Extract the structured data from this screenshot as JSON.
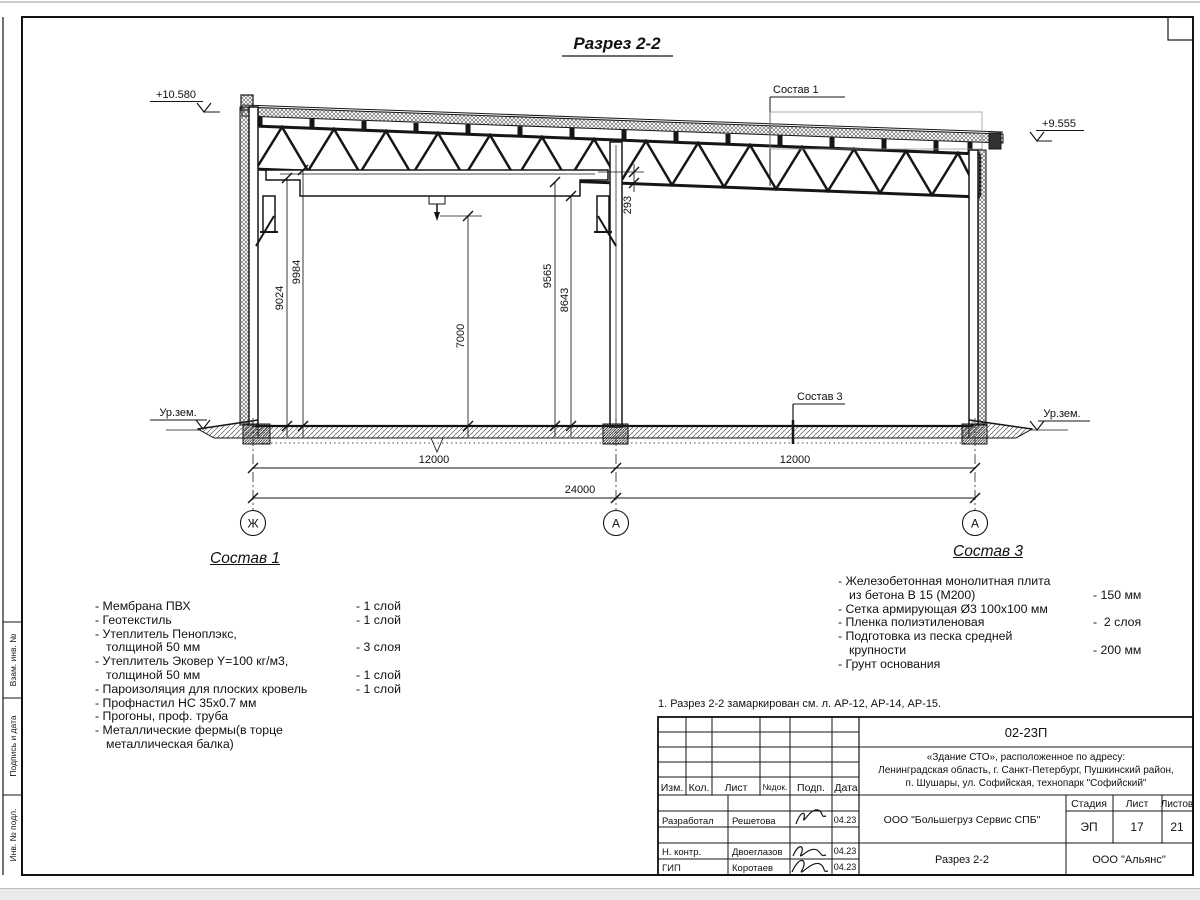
{
  "title": "Разрез 2-2",
  "note": "1. Разрез 2-2 замаркирован см. л. АР-12, АР-14, АР-15.",
  "drawing": {
    "elevations": {
      "left": "+10.580",
      "right": "+9.555"
    },
    "ground_labels": {
      "left": "Ур.зем.",
      "right": "Ур.зем."
    },
    "leaders": {
      "top": "Состав 1",
      "bottom": "Состав 3"
    },
    "dims": {
      "v1": "9024",
      "v2": "9984",
      "v3": "7000",
      "v4": "9565",
      "v5": "8643",
      "v6": "293",
      "bay1": "12000",
      "bay2": "12000",
      "total": "24000"
    },
    "axes": [
      "Ж",
      "А",
      "А"
    ]
  },
  "composition1": {
    "title": "Состав 1",
    "items": [
      {
        "text": "- Мембрана ПВХ",
        "qty": "- 1 слой"
      },
      {
        "text": "- Геотекстиль",
        "qty": "- 1 слой"
      },
      {
        "text": "- Утеплитель Пеноплэкс,\nтолщиной 50 мм",
        "qty": "- 3 слоя"
      },
      {
        "text": "- Утеплитель Эковер Y=100 кг/м3,\nтолщиной 50 мм",
        "qty": "- 1 слой"
      },
      {
        "text": "- Пароизоляция для плоских кровель",
        "qty": "- 1 слой"
      },
      {
        "text": "- Профнастил НС 35х0.7 мм",
        "qty": ""
      },
      {
        "text": "- Прогоны, проф. труба",
        "qty": ""
      },
      {
        "text": "- Металлические фермы(в торце металлическая балка)",
        "qty": ""
      }
    ]
  },
  "composition3": {
    "title": "Состав 3",
    "items": [
      {
        "text": "- Железобетонная  монолитная плита\nиз бетона В 15 (М200)",
        "qty": "- 150 мм"
      },
      {
        "text": "- Сетка армирующая Ø3 100х100 мм",
        "qty": ""
      },
      {
        "text": "- Пленка полиэтиленовая",
        "qty": "-  2 слоя"
      },
      {
        "text": "- Подготовка из песка средней\nкрупности",
        "qty": "- 200 мм"
      },
      {
        "text": "- Грунт основания",
        "qty": ""
      }
    ]
  },
  "titleblock": {
    "doc_number": "02-23П",
    "project_lines": [
      "«Здание СТО», расположенное по адресу:",
      "Ленинградская область, г. Санкт-Петербург, Пушкинский район,",
      "п. Шушары, ул. Софийская, технопарк \"Софийский\""
    ],
    "columns": [
      "Изм.",
      "Кол.",
      "Лист",
      "№док.",
      "Подп.",
      "Дата"
    ],
    "rows": [
      {
        "role": "Разработал",
        "name": "Решетова",
        "date": "04.23"
      },
      {
        "role": "Н. контр.",
        "name": "Двоеглазов",
        "date": "04.23"
      },
      {
        "role": "ГИП",
        "name": "Коротаев",
        "date": "04.23"
      }
    ],
    "org": "ООО \"Большегруз Сервис СПБ\"",
    "stage_label": "Стадия",
    "sheet_label": "Лист",
    "sheets_label": "Листов",
    "stage": "ЭП",
    "sheet": "17",
    "sheets": "21",
    "drawing_name": "Разрез 2-2",
    "company": "ООО \"Альянс\""
  },
  "side_strip": [
    "Взам. инв. №",
    "Подпись и дата",
    "Инв. № подл."
  ],
  "colors": {
    "line": "#1a1a1a",
    "paper": "#ffffff",
    "page_edge": "#e8e8e8"
  }
}
